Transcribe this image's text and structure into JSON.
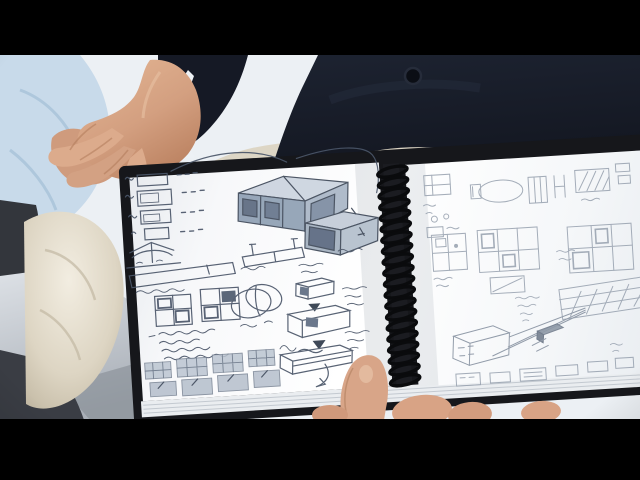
{
  "frame": {
    "width": 640,
    "height": 480,
    "letterbox_top_px": 55,
    "letterbox_bottom_px": 61
  },
  "colors": {
    "letterbox": "#000000",
    "background": "#ecf0f4",
    "background_shade": "#d9dfe5",
    "floor": "#b9bfc6",
    "floor_dark": "#878d95",
    "sleeve_blue": "#c8daea",
    "sleeve_blue_shadow": "#a3bfd6",
    "trousers_dark": "#33363c",
    "sweater": "#151925",
    "sweater_highlight": "#2c3345",
    "shirt_cuff": "#edf1f5",
    "skin": "#d8a588",
    "skin_shadow": "#b07a5a",
    "skin_highlight": "#e8c2a4",
    "khaki": "#ddd6c5",
    "khaki_bright": "#efe9db",
    "khaki_shadow": "#c2b8a2",
    "cover": "#16171b",
    "page": "#f9fafb",
    "page_shade": "#e2e6eb",
    "page_edge_line": "#c3c9d0",
    "spiral": "#0a0b0d",
    "pencil_dark": "#4b5669",
    "pencil_light": "#96a0ae",
    "sketch_fill_light": "#ccd4df",
    "sketch_fill_mid": "#a9b6c6",
    "sketch_fill_deep": "#8fa0b4",
    "sketch_fill_dark": "#5c6a80",
    "sketch_arrow": "#2f3a4a"
  },
  "sketchbook": {
    "type": "spiral-bound-sketchbook",
    "spiral_loop_count": 20,
    "left_page_sketches": [
      "thumbnail-frames-column",
      "connector-line",
      "modular-box-isometric",
      "open-box-isometric",
      "fold-mechanism",
      "side-profile-bars",
      "window-grid-pair",
      "ellipse-diagram",
      "handwritten-notes",
      "shaded-swatch-grid",
      "detail-boxes-column",
      "arrow-down-markers",
      "curved-arrow"
    ],
    "right_page_sketches": [
      "small-frames-row",
      "ellipse-sketch",
      "hatched-panel",
      "floor-plan-grids",
      "large-grid",
      "hatched-band",
      "perspective-box",
      "convergence-lines",
      "small-boxes-row",
      "scribble-annotations"
    ]
  },
  "scene_elements": [
    "clasped-hands",
    "dark-sweater",
    "sweater-button",
    "shirt-cuff",
    "blue-shirt-sleeve",
    "khaki-trousers-lap",
    "dark-trousers",
    "spiral-sketchbook",
    "holding-hand"
  ]
}
